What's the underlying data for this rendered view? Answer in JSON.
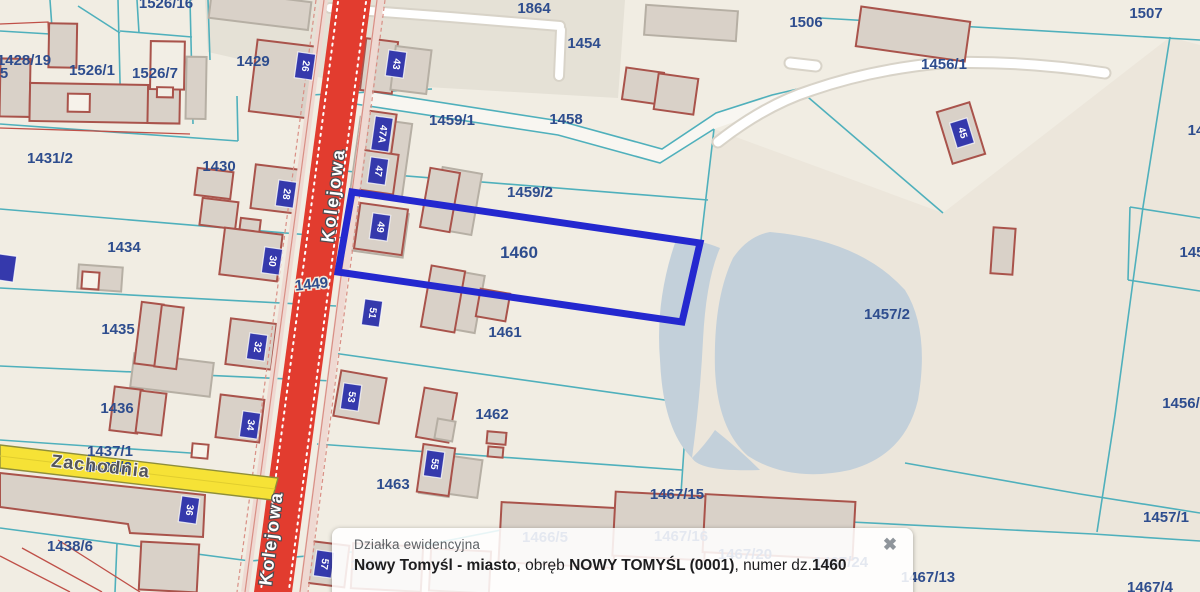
{
  "popup": {
    "title": "Działka ewidencyjna",
    "close_icon": "✖",
    "line_parts": [
      {
        "text": "Nowy Tomyśl - miasto",
        "bold": true
      },
      {
        "text": ", obręb ",
        "bold": false
      },
      {
        "text": "NOWY TOMYŚL (0001)",
        "bold": true
      },
      {
        "text": ", numer dz.",
        "bold": false
      },
      {
        "text": "1460",
        "bold": true
      }
    ]
  },
  "map": {
    "selected_parcel": "1460",
    "colors": {
      "background": "#f1ede3",
      "parcel_line": "#4fb0bc",
      "building_fill": "#d9d1c8",
      "building_stroke": "#a9534b",
      "road_red": "#e23c2f",
      "road_yellow": "#f6e236",
      "lake": "#c3d0da",
      "selection_blue": "#2428cf",
      "marker_blue": "#3539ac",
      "label_blue": "#2e4d8e"
    },
    "streets": [
      {
        "name": "Kolejowa",
        "x": 339,
        "y": 196,
        "angle": -83,
        "style": "road-red"
      },
      {
        "name": "Kolejowa",
        "x": 277,
        "y": 539,
        "angle": -83,
        "style": "road-red"
      },
      {
        "name": "Zachodnia",
        "x": 100,
        "y": 472,
        "angle": 6.3,
        "style": "road-yellow"
      }
    ],
    "parcel_labels": [
      {
        "text": "1526/16",
        "x": 166,
        "y": 8
      },
      {
        "text": "1864",
        "x": 534,
        "y": 13
      },
      {
        "text": "1454",
        "x": 584,
        "y": 48
      },
      {
        "text": "1506",
        "x": 806,
        "y": 27
      },
      {
        "text": "1507",
        "x": 1146,
        "y": 18
      },
      {
        "text": "1456/1",
        "x": 944,
        "y": 69
      },
      {
        "text": "1428/19",
        "x": 24,
        "y": 65
      },
      {
        "text": "5",
        "x": 4,
        "y": 78
      },
      {
        "text": "1526/1",
        "x": 92,
        "y": 75
      },
      {
        "text": "1526/7",
        "x": 155,
        "y": 78
      },
      {
        "text": "1429",
        "x": 253,
        "y": 66
      },
      {
        "text": "1459/1",
        "x": 452,
        "y": 125
      },
      {
        "text": "1458",
        "x": 566,
        "y": 124
      },
      {
        "text": "1431/2",
        "x": 50,
        "y": 163
      },
      {
        "text": "1430",
        "x": 219,
        "y": 171
      },
      {
        "text": "1459/2",
        "x": 530,
        "y": 197
      },
      {
        "text": "1460",
        "x": 519,
        "y": 258,
        "size": 17
      },
      {
        "text": "1449",
        "x": 312,
        "y": 289,
        "angle": -6,
        "halo": true
      },
      {
        "text": "1434",
        "x": 124,
        "y": 252
      },
      {
        "text": "1435",
        "x": 118,
        "y": 334
      },
      {
        "text": "1461",
        "x": 505,
        "y": 337
      },
      {
        "text": "1457/2",
        "x": 887,
        "y": 319
      },
      {
        "text": "1436",
        "x": 117,
        "y": 413
      },
      {
        "text": "1437/1",
        "x": 110,
        "y": 456
      },
      {
        "text": "1437/2",
        "x": 109,
        "y": 472
      },
      {
        "text": "1462",
        "x": 492,
        "y": 419
      },
      {
        "text": "1463",
        "x": 393,
        "y": 489
      },
      {
        "text": "1438/6",
        "x": 70,
        "y": 551
      },
      {
        "text": "1467/15",
        "x": 677,
        "y": 499
      },
      {
        "text": "1457/1",
        "x": 1166,
        "y": 522
      },
      {
        "text": "1467/13",
        "x": 928,
        "y": 582
      },
      {
        "text": "1467/4",
        "x": 1150,
        "y": 592
      },
      {
        "text": "14",
        "x": 1196,
        "y": 135
      },
      {
        "text": "145",
        "x": 1192,
        "y": 257
      },
      {
        "text": "1456/",
        "x": 1181,
        "y": 408
      },
      {
        "text": "1466/5",
        "x": 545,
        "y": 542,
        "color": "#8fa3c8"
      },
      {
        "text": "1467/16",
        "x": 681,
        "y": 541,
        "color": "#8fa3c8"
      },
      {
        "text": "1467/20",
        "x": 745,
        "y": 559,
        "color": "#8fa3c8"
      },
      {
        "text": "1467/24",
        "x": 841,
        "y": 567,
        "color": "#a9b4d2"
      },
      {
        "text": "1464",
        "x": 367,
        "y": 570,
        "color": "#c08884"
      }
    ],
    "address_markers": [
      {
        "text": "26",
        "x": 305,
        "y": 66,
        "angle": 8
      },
      {
        "text": "43",
        "x": 396,
        "y": 64,
        "angle": 8
      },
      {
        "text": "47A",
        "x": 382,
        "y": 134,
        "angle": 8
      },
      {
        "text": "47",
        "x": 378,
        "y": 171,
        "angle": 8
      },
      {
        "text": "49",
        "x": 380,
        "y": 227,
        "angle": 8
      },
      {
        "text": "28",
        "x": 286,
        "y": 194,
        "angle": 8
      },
      {
        "text": "30",
        "x": 272,
        "y": 261,
        "angle": 8
      },
      {
        "text": "51",
        "x": 372,
        "y": 313,
        "angle": 8
      },
      {
        "text": "32",
        "x": 257,
        "y": 347,
        "angle": 8
      },
      {
        "text": "53",
        "x": 351,
        "y": 397,
        "angle": 8
      },
      {
        "text": "34",
        "x": 250,
        "y": 425,
        "angle": 8
      },
      {
        "text": "55",
        "x": 434,
        "y": 464,
        "angle": 8
      },
      {
        "text": "36",
        "x": 189,
        "y": 510,
        "angle": 8
      },
      {
        "text": "57",
        "x": 324,
        "y": 564,
        "angle": 8
      },
      {
        "text": "45",
        "x": 962,
        "y": 133,
        "angle": -17
      },
      {
        "text": "",
        "x": 6,
        "y": 268,
        "angle": 8
      }
    ]
  }
}
